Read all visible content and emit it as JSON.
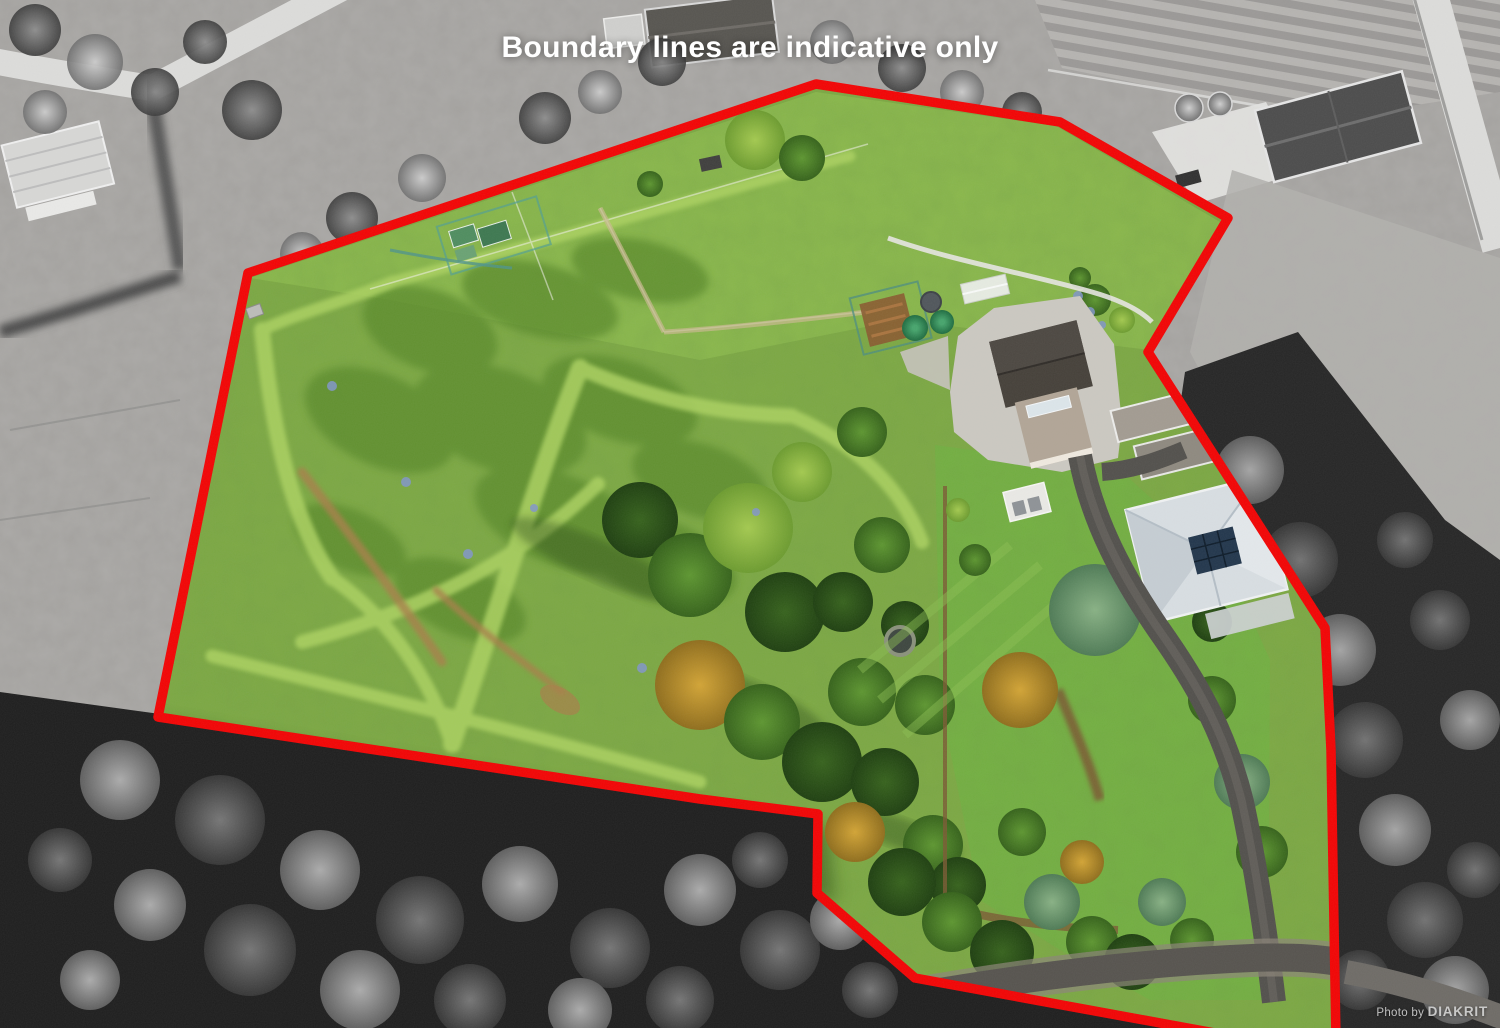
{
  "overlay": {
    "disclaimer": "Boundary lines are indicative only",
    "credit_prefix": "Photo by",
    "credit_brand": "DIAKRIT"
  },
  "boundary": {
    "points": "816,84 1060,122 1228,218 1148,352 1325,628 1331,750 1336,1040 1242,1038 915,978 817,893 818,814 700,799 158,717 248,273"
  },
  "theme": {
    "boundary-red": "#f20404",
    "boundary-width": "9.5px",
    "disclaimer-color": "#ffffff",
    "credit-color": "#d6d6d6",
    "gray-base": "#a3a19e",
    "gray-field": "#b2b0ad",
    "forest-dark": "#1e1e1e",
    "road-white": "#dcdcda",
    "road-gravel": "#8b8478",
    "concrete": "#cbc8c1",
    "asphalt": "#52504c",
    "grass-base": "#7da943",
    "grass-top": "#8cb94d",
    "lawn": "#72b041",
    "mown": "#abd161",
    "dirt": "#a87f49",
    "hedge-brown": "#7a5a33",
    "roof-barn": "#454039",
    "roof-tan": "#b1a596",
    "roof-house": "#d8dee2",
    "solar": "#22364c",
    "tank-green": "#2f9e4e"
  }
}
